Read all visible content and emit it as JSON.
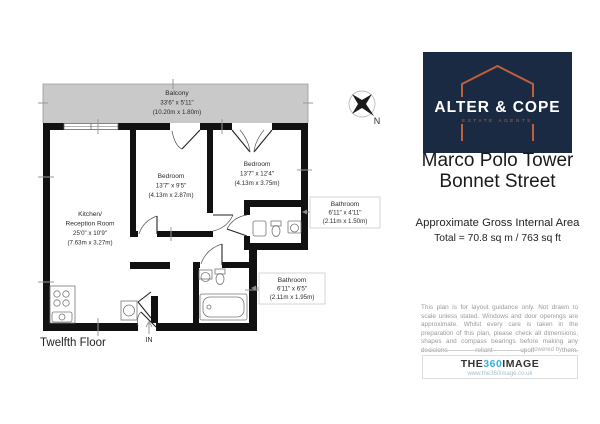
{
  "plan": {
    "floor_label": "Twelfth Floor",
    "entrance_label": "IN",
    "compass_label": "N",
    "rooms": {
      "balcony": {
        "name": "Balcony",
        "imperial": "33'6\" x 5'11\"",
        "metric": "(10.20m x 1.80m)"
      },
      "bedroom1": {
        "name": "Bedroom",
        "imperial": "13'7\" x 9'5\"",
        "metric": "(4.13m x 2.87m)"
      },
      "bedroom2": {
        "name": "Bedroom",
        "imperial": "13'7\" x 12'4\"",
        "metric": "(4.13m x 3.75m)"
      },
      "kitchen": {
        "name_line1": "Kitchen/",
        "name_line2": "Reception Room",
        "imperial": "25'0\" x 10'9\"",
        "metric": "(7.63m x 3.27m)"
      },
      "bathroom_ensuite": {
        "name": "Bathroom",
        "imperial": "6'11\" x 4'11\"",
        "metric": "(2.11m x 1.50m)"
      },
      "bathroom": {
        "name": "Bathroom",
        "imperial": "6'11\" x 6'5\"",
        "metric": "(2.11m x 1.95m)"
      }
    }
  },
  "branding": {
    "logo_name": "ALTER & COPE",
    "logo_tagline": "ESTATE AGENTS",
    "colors": {
      "navy": "#1b2a43",
      "orange": "#c05f3c"
    }
  },
  "property": {
    "title_line1": "Marco Polo Tower",
    "title_line2": "Bonnet Street",
    "area_heading": "Approximate Gross Internal Area",
    "area_total": "Total = 70.8 sq m / 763 sq ft"
  },
  "disclaimer": "This plan is for layout guidance only. Not drawn to scale unless stated. Windows and door openings are approximate. Whilst every care is taken in the preparation of this plan, please check all dimensions, shapes and compass bearings before making any decisions reliant upon them.",
  "footer": {
    "powered_by": "powered by",
    "brand_the": "THE",
    "brand_360": "360",
    "brand_image": "IMAGE",
    "brand_url": "www.the360image.co.uk",
    "cyan": "#3ab0dc"
  }
}
